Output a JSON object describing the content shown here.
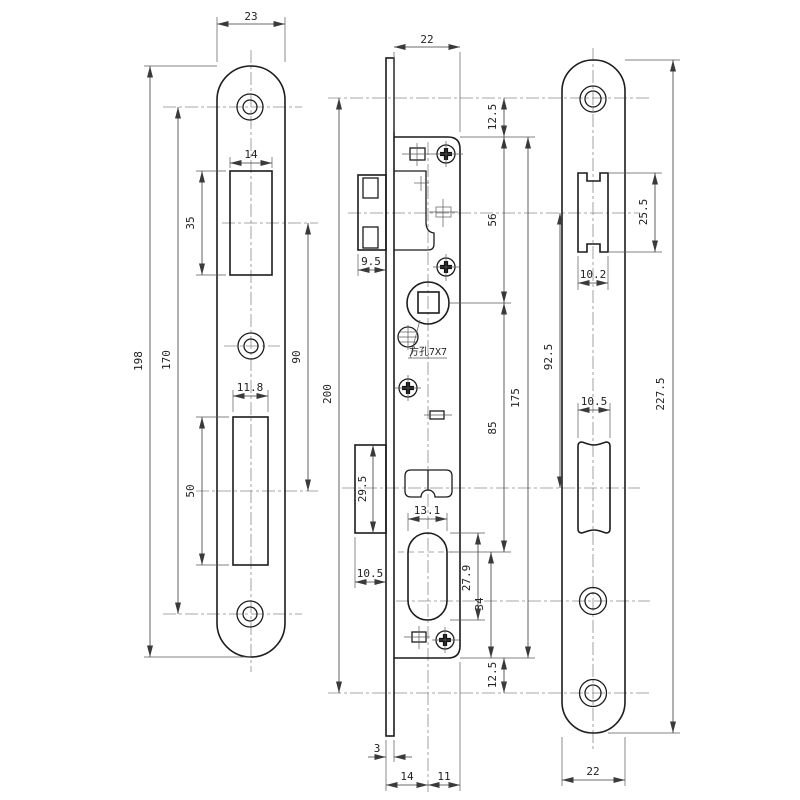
{
  "title": "Mortise lock technical drawing",
  "views": {
    "strike_plate": {
      "dims": {
        "plate_width": "23",
        "latch_cutout_width": "14",
        "latch_cutout_height": "35",
        "overall_height": "198",
        "screw_hole_spacing": "170",
        "cutout_center_distance": "90",
        "bolt_cutout_width": "11.8",
        "bolt_cutout_height": "50"
      }
    },
    "lock_body": {
      "dims": {
        "case_width": "22",
        "faceplate_top_offset": "12.5",
        "case_top_to_spindle": "56",
        "latch_projection": "9.5",
        "screw_hole_spacing": "200",
        "case_height": "175",
        "spindle_to_cylinder": "85",
        "deadbolt_height": "29.5",
        "deadbolt_projection": "10.5",
        "cylinder_width": "13.1",
        "cylinder_height": "27.9",
        "cylinder_to_case_bottom": "34",
        "faceplate_bottom_offset": "12.5",
        "faceplate_thickness": "3",
        "backset_front": "14",
        "backset_rear": "11",
        "square_hole_note": "方孔7X7"
      }
    },
    "faceplate": {
      "dims": {
        "latch_cutout_height": "25.5",
        "latch_cutout_width": "10.2",
        "cutout_center_distance": "92.5",
        "overall_height": "227.5",
        "bolt_cutout_width": "10.5",
        "plate_width": "22"
      }
    }
  }
}
